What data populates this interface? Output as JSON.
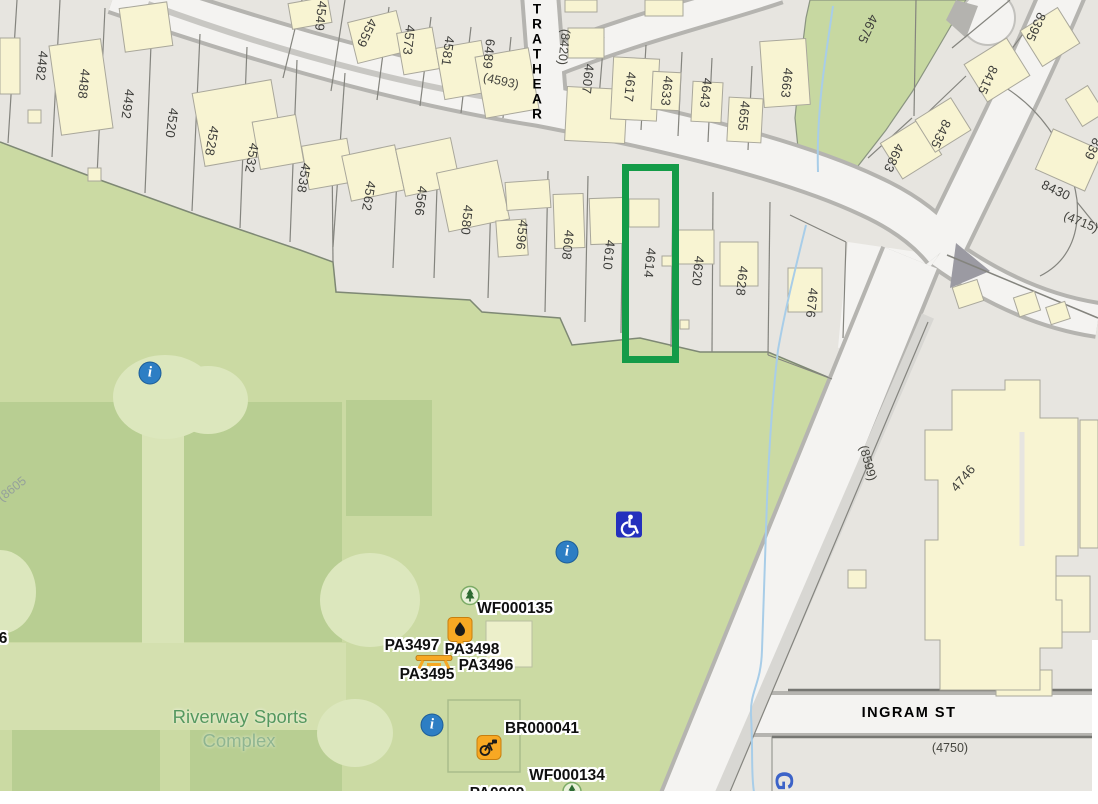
{
  "map": {
    "highlight": {
      "color": "#149b48",
      "x": 622,
      "y": 164,
      "w": 57,
      "h": 199
    },
    "street_labels": [
      {
        "t": "STRATHEAR",
        "x": 537,
        "y": 54,
        "r": 0,
        "cls": "vert"
      },
      {
        "t": "INGRAM ST",
        "x": 909,
        "y": 713,
        "r": 0
      }
    ],
    "parcel_labels": [
      {
        "t": "4482",
        "x": 42,
        "y": 66,
        "r": 96
      },
      {
        "t": "4488",
        "x": 84,
        "y": 84,
        "r": 96
      },
      {
        "t": "4492",
        "x": 128,
        "y": 104,
        "r": 98
      },
      {
        "t": "4520",
        "x": 172,
        "y": 123,
        "r": 98
      },
      {
        "t": "4528",
        "x": 212,
        "y": 141,
        "r": 100
      },
      {
        "t": "4532",
        "x": 252,
        "y": 158,
        "r": 100
      },
      {
        "t": "4538",
        "x": 304,
        "y": 178,
        "r": 100
      },
      {
        "t": "4549",
        "x": 321,
        "y": 16,
        "r": 96
      },
      {
        "t": "4559",
        "x": 367,
        "y": 33,
        "r": 115
      },
      {
        "t": "4573",
        "x": 409,
        "y": 40,
        "r": 96
      },
      {
        "t": "4581",
        "x": 448,
        "y": 51,
        "r": 98
      },
      {
        "t": "6489",
        "x": 489,
        "y": 54,
        "r": 96
      },
      {
        "t": "4562",
        "x": 369,
        "y": 196,
        "r": 100
      },
      {
        "t": "4566",
        "x": 421,
        "y": 201,
        "r": 97
      },
      {
        "t": "4580",
        "x": 467,
        "y": 220,
        "r": 96
      },
      {
        "t": "4596",
        "x": 522,
        "y": 235,
        "r": 96
      },
      {
        "t": "4608",
        "x": 568,
        "y": 245,
        "r": 96
      },
      {
        "t": "4610",
        "x": 609,
        "y": 255,
        "r": 96
      },
      {
        "t": "4614",
        "x": 650,
        "y": 263,
        "r": 96
      },
      {
        "t": "4620",
        "x": 698,
        "y": 271,
        "r": 96
      },
      {
        "t": "4628",
        "x": 742,
        "y": 281,
        "r": 96
      },
      {
        "t": "4676",
        "x": 812,
        "y": 303,
        "r": 96
      },
      {
        "t": "4607",
        "x": 588,
        "y": 79,
        "r": 96
      },
      {
        "t": "4617",
        "x": 630,
        "y": 87,
        "r": 96
      },
      {
        "t": "4633",
        "x": 667,
        "y": 91,
        "r": 96
      },
      {
        "t": "4643",
        "x": 706,
        "y": 93,
        "r": 96
      },
      {
        "t": "4655",
        "x": 744,
        "y": 116,
        "r": 96
      },
      {
        "t": "4663",
        "x": 787,
        "y": 83,
        "r": 96
      },
      {
        "t": "4675",
        "x": 868,
        "y": 29,
        "r": 115
      },
      {
        "t": "4683",
        "x": 894,
        "y": 158,
        "r": 115
      },
      {
        "t": "8435",
        "x": 941,
        "y": 134,
        "r": 115
      },
      {
        "t": "8415",
        "x": 988,
        "y": 80,
        "r": 115
      },
      {
        "t": "8395",
        "x": 1036,
        "y": 27,
        "r": 115
      },
      {
        "t": "839",
        "x": 1093,
        "y": 149,
        "r": 115
      },
      {
        "t": "8430",
        "x": 1056,
        "y": 190,
        "r": 25
      },
      {
        "t": "4746",
        "x": 963,
        "y": 478,
        "r": -50
      }
    ],
    "ref_labels": [
      {
        "t": "(4593)",
        "x": 501,
        "y": 81,
        "r": 12
      },
      {
        "t": "(8420)",
        "x": 564,
        "y": 47,
        "r": 96
      },
      {
        "t": "(4715)",
        "x": 1081,
        "y": 222,
        "r": 22
      },
      {
        "t": "(8599)",
        "x": 868,
        "y": 463,
        "r": 75
      },
      {
        "t": "(8605",
        "x": 12,
        "y": 489,
        "r": -38,
        "cls": "faint"
      },
      {
        "t": "(4750)",
        "x": 950,
        "y": 748,
        "r": 0
      }
    ],
    "place_labels": [
      {
        "t": "Riverway Sports",
        "x": 240,
        "y": 717,
        "cls": "place1"
      },
      {
        "t": "Complex",
        "x": 239,
        "y": 741,
        "cls": "place2"
      }
    ],
    "asset_labels": [
      {
        "t": "WF000135",
        "x": 515,
        "y": 609
      },
      {
        "t": "PA3497",
        "x": 412,
        "y": 646
      },
      {
        "t": "PA3498",
        "x": 472,
        "y": 650
      },
      {
        "t": "PA3495",
        "x": 427,
        "y": 675
      },
      {
        "t": "PA3496",
        "x": 486,
        "y": 666
      },
      {
        "t": "BR000041",
        "x": 542,
        "y": 729
      },
      {
        "t": "WF000134",
        "x": 567,
        "y": 776
      },
      {
        "t": "PA0909",
        "x": 497,
        "y": 794
      },
      {
        "t": "6",
        "x": 3,
        "y": 639
      }
    ],
    "misc_labels": [
      {
        "t": "G",
        "x": 783,
        "y": 781,
        "r": 90,
        "cls": "gmark"
      }
    ],
    "icons": [
      {
        "type": "info",
        "x": 150,
        "y": 373
      },
      {
        "type": "info",
        "x": 567,
        "y": 552
      },
      {
        "type": "info",
        "x": 432,
        "y": 725
      },
      {
        "type": "wheelchair",
        "x": 629,
        "y": 527
      },
      {
        "type": "tree",
        "x": 470,
        "y": 598
      },
      {
        "type": "tree",
        "x": 572,
        "y": 794
      },
      {
        "type": "fountain",
        "x": 460,
        "y": 634
      },
      {
        "type": "picnic-table",
        "x": 434,
        "y": 664
      },
      {
        "type": "bike-rack",
        "x": 489,
        "y": 750
      }
    ]
  }
}
